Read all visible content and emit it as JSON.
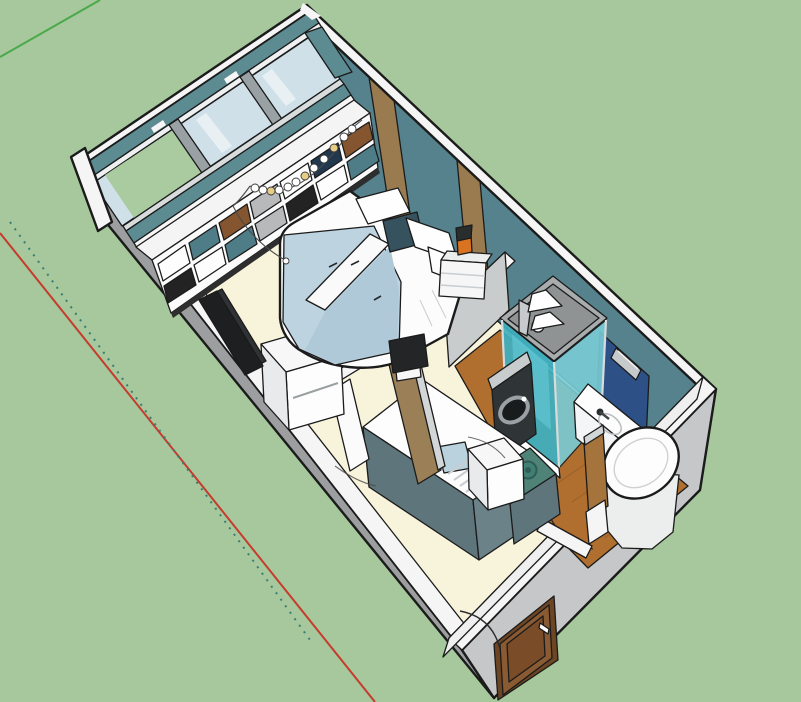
{
  "meta": {
    "description": "3D cutaway isometric view of a studio apartment floor plan on a green ground plane with drawing axes",
    "rooms": [
      "bedroom-living",
      "kitchen",
      "bathroom",
      "entry-hall"
    ]
  },
  "palette": {
    "edge": "#1b1b1b",
    "background": "#a6c89c",
    "axis_green": "#4aa94a",
    "axis_red": "#c53b2c",
    "axis_dotted_teal": "#3a7d74",
    "wall_top_white": "#f5f5f5",
    "wall_outer_gray": "#9c9ea0",
    "wall_outer_light": "#c6c7c9",
    "wall_inner_white": "#efefef",
    "wall_teal": "#55828c",
    "wall_teal_top": "#5d8b92",
    "stripe_brown": "#9a7b50",
    "window_frame": "#9aa1a5",
    "window_frame_light": "#eef0f1",
    "window_frame_bottom": "#d8dcdd",
    "glass_blue": "#cfe0e8",
    "glass_streak": "#f2f7f9",
    "glass_green": "#a9cb9f",
    "sill_white": "#f6f6f6",
    "floor_cream": "#f8f4dc",
    "floor_wood": "#b06f2e",
    "bath_wall_gray": "#c9cccd",
    "shelf_white": "#f4f4f4",
    "shelf_face": "#fbfbfb",
    "shelf_kick": "#2e2e2e",
    "bed_white": "#fcfcfc",
    "blanket_blue": "#bdd3e0",
    "blanket_blue_dark": "#b0c9d8",
    "fold_white": "#fafafa",
    "pillow_white": "#fefefe",
    "pillow_dark": "#35525e",
    "nightstand_white": "#f6f6f6",
    "nightstand_top": "#eceded",
    "lamp_orange": "#d9731f",
    "lamp_dark": "#2a2d2e",
    "tv_black": "#1d1f20",
    "tv_black2": "#303335",
    "tv_foot": "#232527",
    "desk_white": "#f7f7f7",
    "desk_side": "#e9eaeb",
    "partition_brown": "#9b7f56",
    "partition_cap": "#d3d6d7",
    "door_leaf_white": "#fbfbfb",
    "counter_white": "#fdfdfd",
    "cabinet_slate": "#5e757c",
    "cabinet_slate2": "#6b8289",
    "stove_teal": "#4f8377",
    "burner_teal": "#3f7f74",
    "sink_blue": "#b9d2de",
    "washer_dark": "#2f3437",
    "washer_top": "#c9cccd",
    "washer_door": "#191c1d",
    "shower_top": "#a8acad",
    "shower_top_inner": "#8f9394",
    "shower_glass": "#3fb0c0",
    "shower_glass_light": "#79ccd6",
    "shower_glass_streak": "#5fc3cf",
    "mirror_navy": "#2d5086",
    "sconce_gray": "#c7cacc",
    "vanity_white": "#fdfdfd",
    "vanity_front": "#f4f5f6",
    "toilet_white": "#fdfdfd",
    "toilet_side": "#eceded",
    "radiator_gray": "#b9bcbd",
    "wood_door": "#a4743c",
    "entry_door": "#8a5a33",
    "entry_door_panel": "#7a4c28",
    "entry_door_frame": "#6e4522",
    "handle_white": "#ffffff",
    "showerhead_white": "#ffffff"
  },
  "shelf": {
    "row1_colors": [
      "#fdfdfd",
      "#4e7d87",
      "#84552e",
      "#b7b9bb",
      "#fdfdfd",
      "#22384e",
      "#84552e"
    ],
    "row2_colors": [
      "#232323",
      "#fdfdfd",
      "#4e7d87",
      "#b7b9bb",
      "#232323",
      "#fdfdfd",
      "#4e7d87"
    ]
  },
  "garland": {
    "bead_colors": [
      "#ffffff",
      "#ffffff",
      "#e7cc86",
      "#ffffff",
      "#ffffff",
      "#ffffff",
      "#e7cc86",
      "#ffffff",
      "#ffffff",
      "#e7cc86",
      "#ffffff",
      "#ffffff"
    ],
    "drop_bead_color": "#ffffff"
  }
}
